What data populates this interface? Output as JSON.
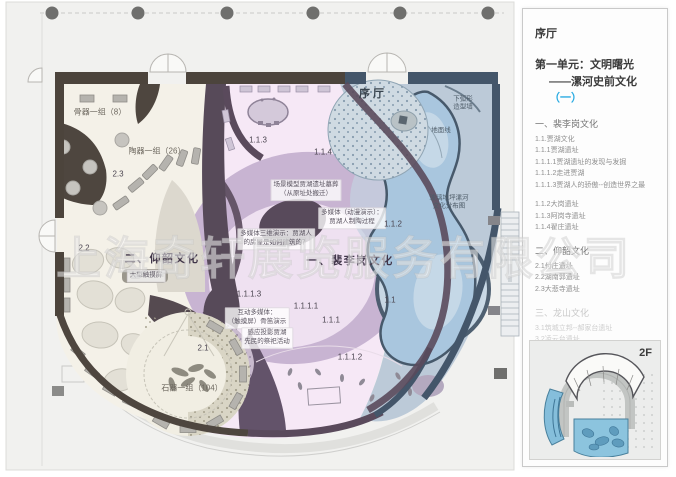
{
  "watermark": "上海奇轩展览服务有限公司",
  "colors": {
    "accent_cyan": "#29abe2",
    "peiligang_pink": "#f6e7f5",
    "lavender_ring": "#c3aecd",
    "yangshao_cream": "#f5f2e9",
    "blue_zone": "#b7c6d3",
    "plum_wall": "#564a59",
    "taupe_wall": "#4c443c",
    "slate_wall": "#44566a"
  },
  "panel": {
    "hall_title": "序厅",
    "unit_line1": "第一单元：文明曙光",
    "unit_line2_prefix": "——漯河史前文化",
    "unit_line2_accent": "（一）",
    "floor_label": "2F",
    "sections": [
      {
        "heading": "一、裴李岗文化",
        "muted": false,
        "items": [
          "1.1.贾湖文化",
          "1.1.1贾湖遗址",
          "1.1.1.1贾湖遗址的发现与发掘",
          "1.1.1.2走进贾湖",
          "1.1.1.3贾湖人的骄傲--创造世界之最",
          "",
          "1.1.2大岗遗址",
          "1.1.3阿岗寺遗址",
          "1.1.4翟庄遗址"
        ]
      },
      {
        "heading": "二、仰韶文化",
        "muted": false,
        "items": [
          "2.1付庄遗址",
          "2.2湖南郭遗址",
          "2.3大悲寺遗址"
        ]
      },
      {
        "heading": "三、龙山文化",
        "muted": true,
        "items": [
          "3.1筑城立邦--郝家台遗址",
          "3.2凌云台遗址",
          "3.3华严寺遗址",
          "3.4漯河市其它龙山文化遗址"
        ]
      }
    ]
  },
  "plan": {
    "labels": [
      {
        "style": "small",
        "name": "exhibit-label-bone-tools",
        "text": "骨器一组（8）",
        "x": 100,
        "y": 112
      },
      {
        "style": "small",
        "name": "exhibit-label-pottery",
        "text": "陶器一组（26）",
        "x": 157,
        "y": 151
      },
      {
        "style": "num",
        "name": "room-code-2-3",
        "text": "2.3",
        "x": 118,
        "y": 174
      },
      {
        "style": "num",
        "name": "room-code-2-2",
        "text": "2.2",
        "x": 84,
        "y": 248
      },
      {
        "style": "big",
        "name": "zone-title-yangshao",
        "text": "二、仰韶文化",
        "x": 162,
        "y": 258
      },
      {
        "style": "box",
        "name": "multimedia-note-touchscreen",
        "text": "大型触摸屏",
        "x": 146,
        "y": 276
      },
      {
        "style": "num",
        "name": "room-code-2-1",
        "text": "2.1",
        "x": 203,
        "y": 348
      },
      {
        "style": "small",
        "name": "exhibit-label-stone-tools",
        "text": "石器一组（104）",
        "x": 192,
        "y": 388
      },
      {
        "style": "big",
        "name": "zone-title-peiligang",
        "text": "一、裴李岗文化",
        "x": 350,
        "y": 260
      },
      {
        "style": "bighall",
        "name": "hall-label-prologue",
        "text": "序厅",
        "x": 373,
        "y": 93
      },
      {
        "style": "smallblue",
        "name": "note-arc-wall",
        "text": "下弧形\n造型墙",
        "x": 463,
        "y": 104
      },
      {
        "style": "smallblue",
        "name": "note-floor-line",
        "text": "地面线",
        "x": 441,
        "y": 131
      },
      {
        "style": "smallblue",
        "name": "note-glass-floor",
        "text": "玻璃地坪漯河\n文化分布图",
        "x": 449,
        "y": 203
      },
      {
        "style": "num",
        "name": "room-code-1-1-3",
        "text": "1.1.3",
        "x": 258,
        "y": 140
      },
      {
        "style": "num",
        "name": "room-code-1-1-4",
        "text": "1.1.4",
        "x": 323,
        "y": 152
      },
      {
        "style": "box",
        "name": "multimedia-note-tomb-model",
        "text": "场景模型贾湖遗址墓葬\n（从原址处搬迁）",
        "x": 306,
        "y": 190
      },
      {
        "style": "box",
        "name": "multimedia-note-pottery-anim",
        "text": "多媒体（动漫演示）：\n贾湖人制陶过程",
        "x": 352,
        "y": 218
      },
      {
        "style": "num",
        "name": "room-code-1-1-2",
        "text": "1.1.2",
        "x": 393,
        "y": 224
      },
      {
        "style": "box",
        "name": "multimedia-note-3d-house",
        "text": "多媒体三维演示：贾湖人\n的房屋是如何建筑的？",
        "x": 276,
        "y": 239
      },
      {
        "style": "num",
        "name": "room-code-1-1-1-3",
        "text": "1.1.1.3",
        "x": 249,
        "y": 294
      },
      {
        "style": "box",
        "name": "multimedia-note-bone-flute",
        "text": "互动多媒体：\n（触摸屏）骨笛演示",
        "x": 257,
        "y": 318
      },
      {
        "style": "num",
        "name": "room-code-1-1-1-1",
        "text": "1.1.1.1",
        "x": 306,
        "y": 306
      },
      {
        "style": "num",
        "name": "room-code-1-1-1",
        "text": "1.1.1",
        "x": 331,
        "y": 320
      },
      {
        "style": "num",
        "name": "room-code-1-1",
        "text": "1.1",
        "x": 390,
        "y": 300
      },
      {
        "style": "box",
        "name": "multimedia-note-projection",
        "text": "感应投影贾湖\n先民的祭祀活动",
        "x": 267,
        "y": 338
      },
      {
        "style": "num",
        "name": "room-code-1-1-1-2",
        "text": "1.1.1.2",
        "x": 350,
        "y": 357
      }
    ]
  }
}
